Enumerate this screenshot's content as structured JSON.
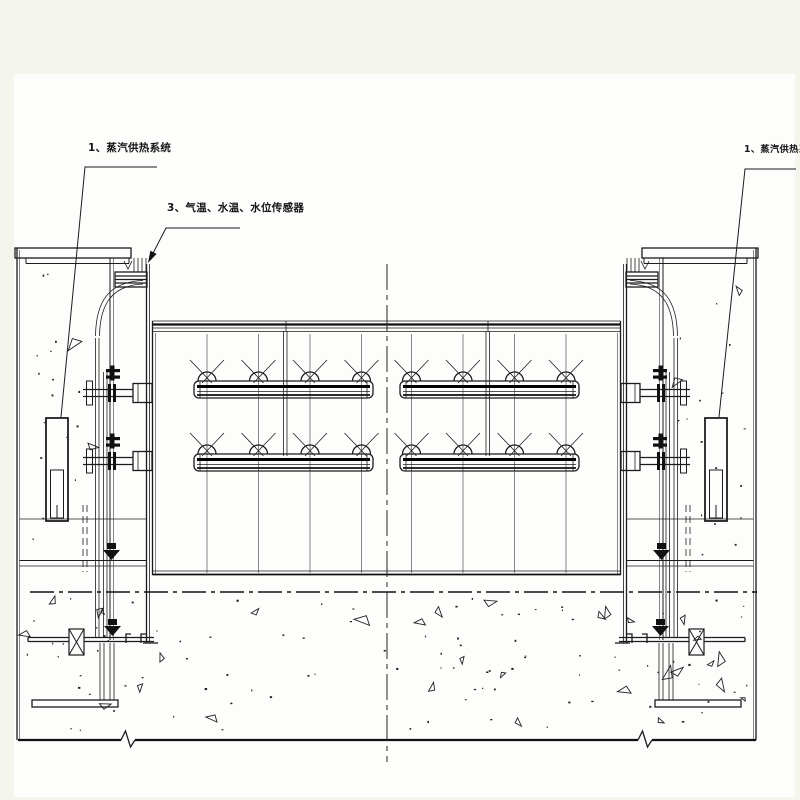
{
  "drawing": {
    "type": "engineering-cad-section",
    "labels": {
      "steam_left": "1、蒸汽供热系统",
      "sensors": "3、气温、水温、水位传感器",
      "steam_right": "1、蒸汽供热系统"
    },
    "colors": {
      "background": "#f4f5ed",
      "paper": "#fdfdfc",
      "line": "#1c1c1c"
    }
  }
}
